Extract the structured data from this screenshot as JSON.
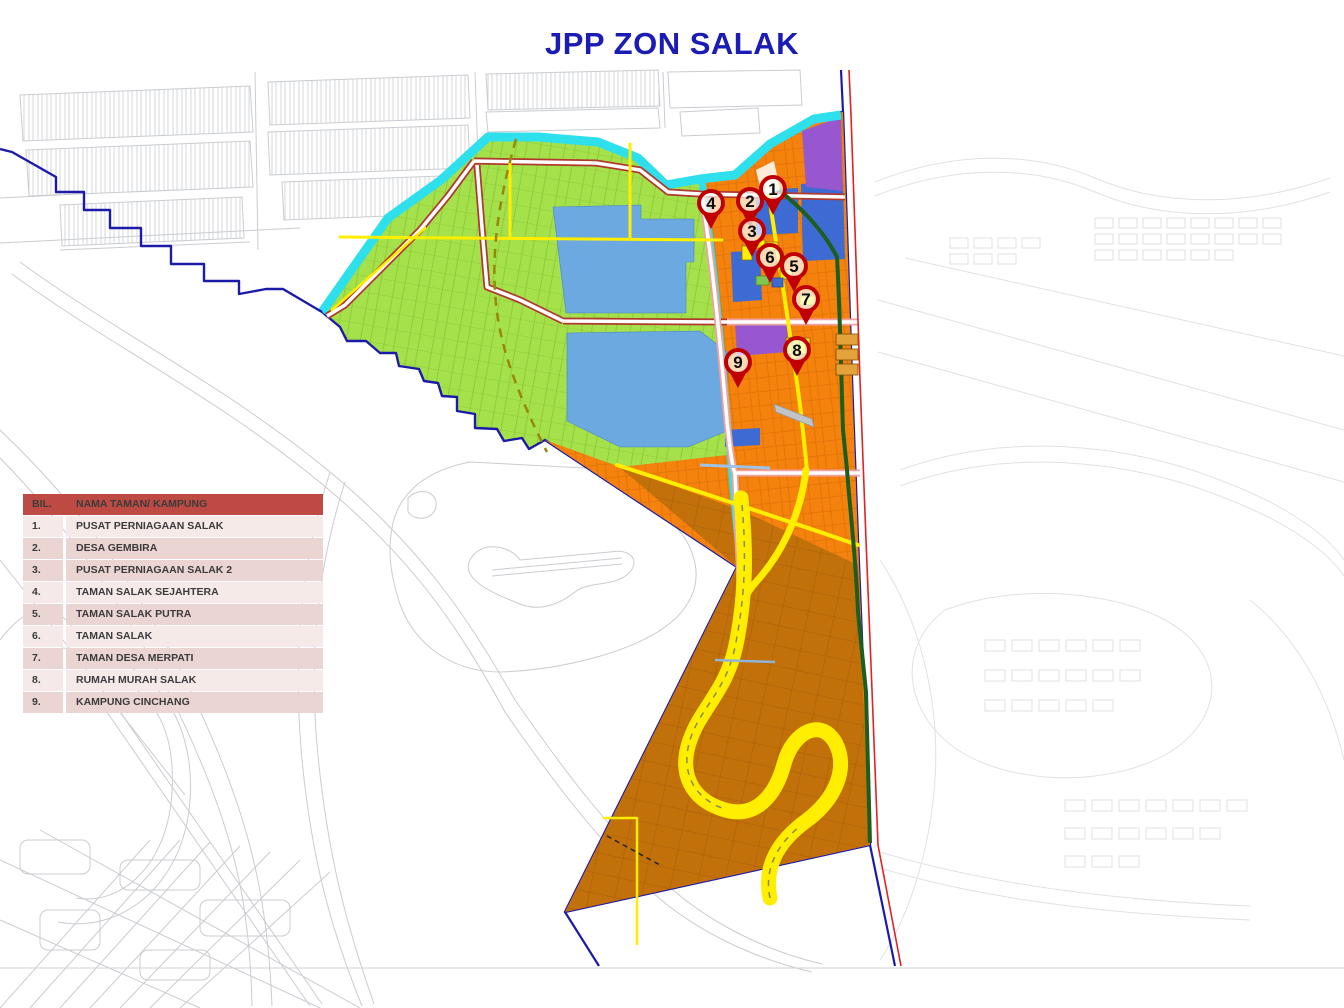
{
  "title": "JPP ZON SALAK",
  "legend": {
    "headers": {
      "bil": "BIL.",
      "name": "NAMA TAMAN/  KAMPUNG"
    },
    "rows": [
      {
        "bil": "1.",
        "name": "PUSAT PERNIAGAAN SALAK"
      },
      {
        "bil": "2.",
        "name": "DESA GEMBIRA"
      },
      {
        "bil": "3.",
        "name": "PUSAT PERNIAGAAN SALAK 2"
      },
      {
        "bil": "4.",
        "name": "TAMAN  SALAK  SEJAHTERA"
      },
      {
        "bil": "5.",
        "name": "TAMAN  SALAK  PUTRA"
      },
      {
        "bil": "6.",
        "name": "TAMAN  SALAK"
      },
      {
        "bil": "7.",
        "name": "TAMAN  DESA  MERPATI"
      },
      {
        "bil": "8.",
        "name": "RUMAH  MURAH SALAK"
      },
      {
        "bil": "9.",
        "name": "KAMPUNG  CINCHANG"
      }
    ]
  },
  "markers": [
    {
      "label": "1"
    },
    {
      "label": "2"
    },
    {
      "label": "3"
    },
    {
      "label": "4"
    },
    {
      "label": "5"
    },
    {
      "label": "6"
    },
    {
      "label": "7"
    },
    {
      "label": "8"
    },
    {
      "label": "9"
    }
  ],
  "colors": {
    "title_text": "#1B1BB5",
    "legend_header_bg": "#BE4A44",
    "legend_row_light": "#F5EAE8",
    "legend_row_dark": "#EBD5D2",
    "zone_green": "#A5E14B",
    "zone_orange": "#F5820D",
    "zone_brown": "#C2700A",
    "river_cyan": "#2EDFEC",
    "lake_blue": "#6BA9E0",
    "parcel_blue": "#3D6BD3",
    "parcel_purple": "#9757CE",
    "road_yellow": "#FFEE00",
    "road_casing_red": "#B03A2E",
    "road_casing_pink": "#F2A0A0",
    "boundary_navy": "#1B1BA8",
    "boundary_red": "#E32222",
    "path_dark_green": "#1D5E20",
    "marker_red": "#C00000",
    "basemap_gray": "#c9ccd1"
  }
}
